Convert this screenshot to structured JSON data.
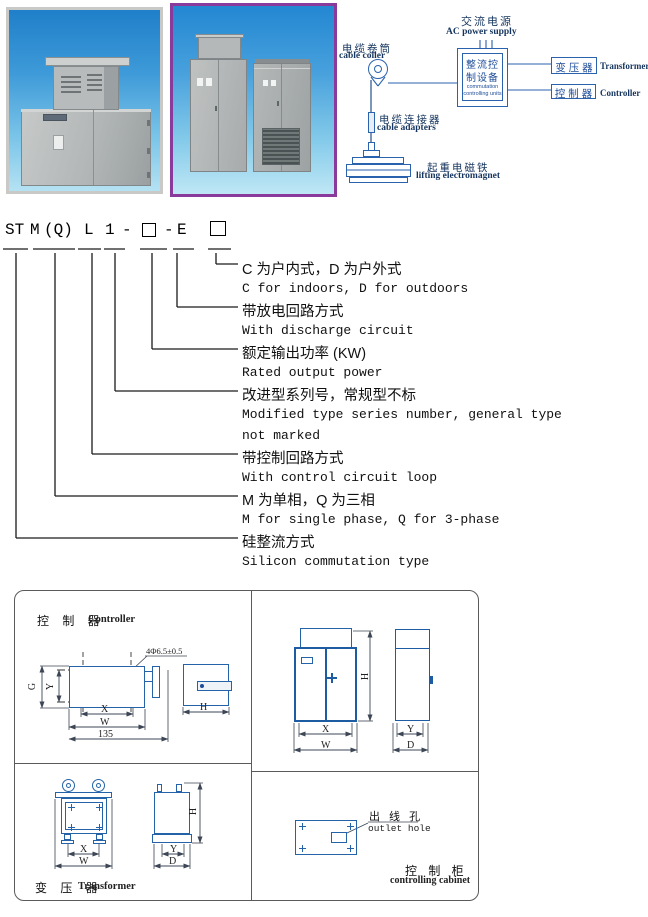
{
  "colors": {
    "diagram_blue": "#2b62ad",
    "diagram_text": "#1f4d99",
    "drawing_blue": "#2463a8",
    "drawing_thick_blue": "#1d5ca3",
    "dim_line": "#3c4654",
    "ink": "#1a1a1a",
    "photo_left_border": "#c9c9c7",
    "photo_right_border": "#8a3a9a"
  },
  "diagram": {
    "ac_power_zh": "交流电源",
    "ac_power_en": "AC power supply",
    "cable_coiler_zh": "电缆卷筒",
    "cable_coiler_en": "cable coiler",
    "rectifier_zh1": "整流控",
    "rectifier_zh2": "制设备",
    "rectifier_en1": "commutation",
    "rectifier_en2": "controlling units",
    "transformer_zh": "变 压 器",
    "transformer_en": "Transformer",
    "controller_zh": "控 制 器",
    "controller_en": "Controller",
    "cable_adapter_zh": "电缆连接器",
    "cable_adapter_en": "cable adapters",
    "magnet_zh": "起重电磁铁",
    "magnet_en": "lifting electromagnet"
  },
  "model": {
    "tokens": [
      "ST",
      "M",
      "(Q)",
      "L",
      "1",
      "-",
      "-",
      "E"
    ]
  },
  "designation": {
    "items": [
      {
        "zh": "C 为户内式，D 为户外式",
        "en": "C for indoors, D for outdoors"
      },
      {
        "zh": "带放电回路方式",
        "en": "With discharge circuit"
      },
      {
        "zh": "额定输出功率 (KW)",
        "en": "Rated output power"
      },
      {
        "zh": "改进型系列号，常规型不标",
        "en": "Modified type series number, general type",
        "en2": "not marked"
      },
      {
        "zh": "带控制回路方式",
        "en": "With control circuit loop"
      },
      {
        "zh": "M 为单相，Q 为三相",
        "en": "M for single phase, Q for 3-phase"
      },
      {
        "zh": "硅整流方式",
        "en": "Silicon commutation type"
      }
    ]
  },
  "drawings": {
    "controller": {
      "title_zh": "控 制 器",
      "title_en": "Controller",
      "annotation": "4Φ6.5±0.5",
      "dims": {
        "g": "G",
        "y": "Y",
        "x": "X",
        "w": "W",
        "len": "135",
        "h": "H"
      }
    },
    "transformer": {
      "title_zh": "变 压 器",
      "title_en": "Transformer",
      "dims": {
        "x": "X",
        "w": "W",
        "h": "H",
        "y": "Y",
        "d": "D"
      }
    },
    "cabinet": {
      "outlet_zh": "出 线 孔",
      "outlet_en": "outlet hole",
      "caption_zh": "控 制 柜",
      "caption_en": "controlling cabinet",
      "dims": {
        "h": "H",
        "x": "X",
        "w": "W",
        "y": "Y",
        "d": "D"
      }
    }
  }
}
